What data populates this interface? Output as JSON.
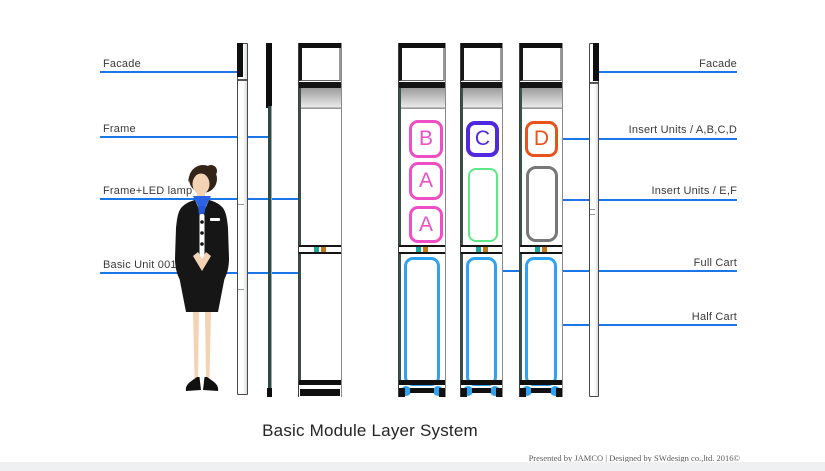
{
  "title": "Basic Module Layer System",
  "credit": "Presented by JAMCO | Designed by SWdesign co.,ltd. 2016©",
  "labels_left": [
    {
      "text": "Facade"
    },
    {
      "text": "Frame"
    },
    {
      "text": "Frame+LED lamp"
    },
    {
      "text": "Basic Unit 001"
    }
  ],
  "labels_right": [
    {
      "text": "Facade"
    },
    {
      "text": "Insert Units / A,B,C,D"
    },
    {
      "text": "Insert Units / E,F"
    },
    {
      "text": "Full Cart"
    },
    {
      "text": "Half Cart"
    }
  ],
  "inserts": {
    "column_a": [
      "B",
      "A",
      "A"
    ],
    "column_b_letter": "C",
    "column_c_letter": "D"
  },
  "colors": {
    "callout_line": "#1b76e8",
    "insert_pink": "#ee4fc4",
    "insert_purple": "#5128e0",
    "insert_orange": "#e8521c",
    "insert_green": "#5ee687",
    "insert_gray": "#777777",
    "cart_blue": "#2ea3f2"
  }
}
